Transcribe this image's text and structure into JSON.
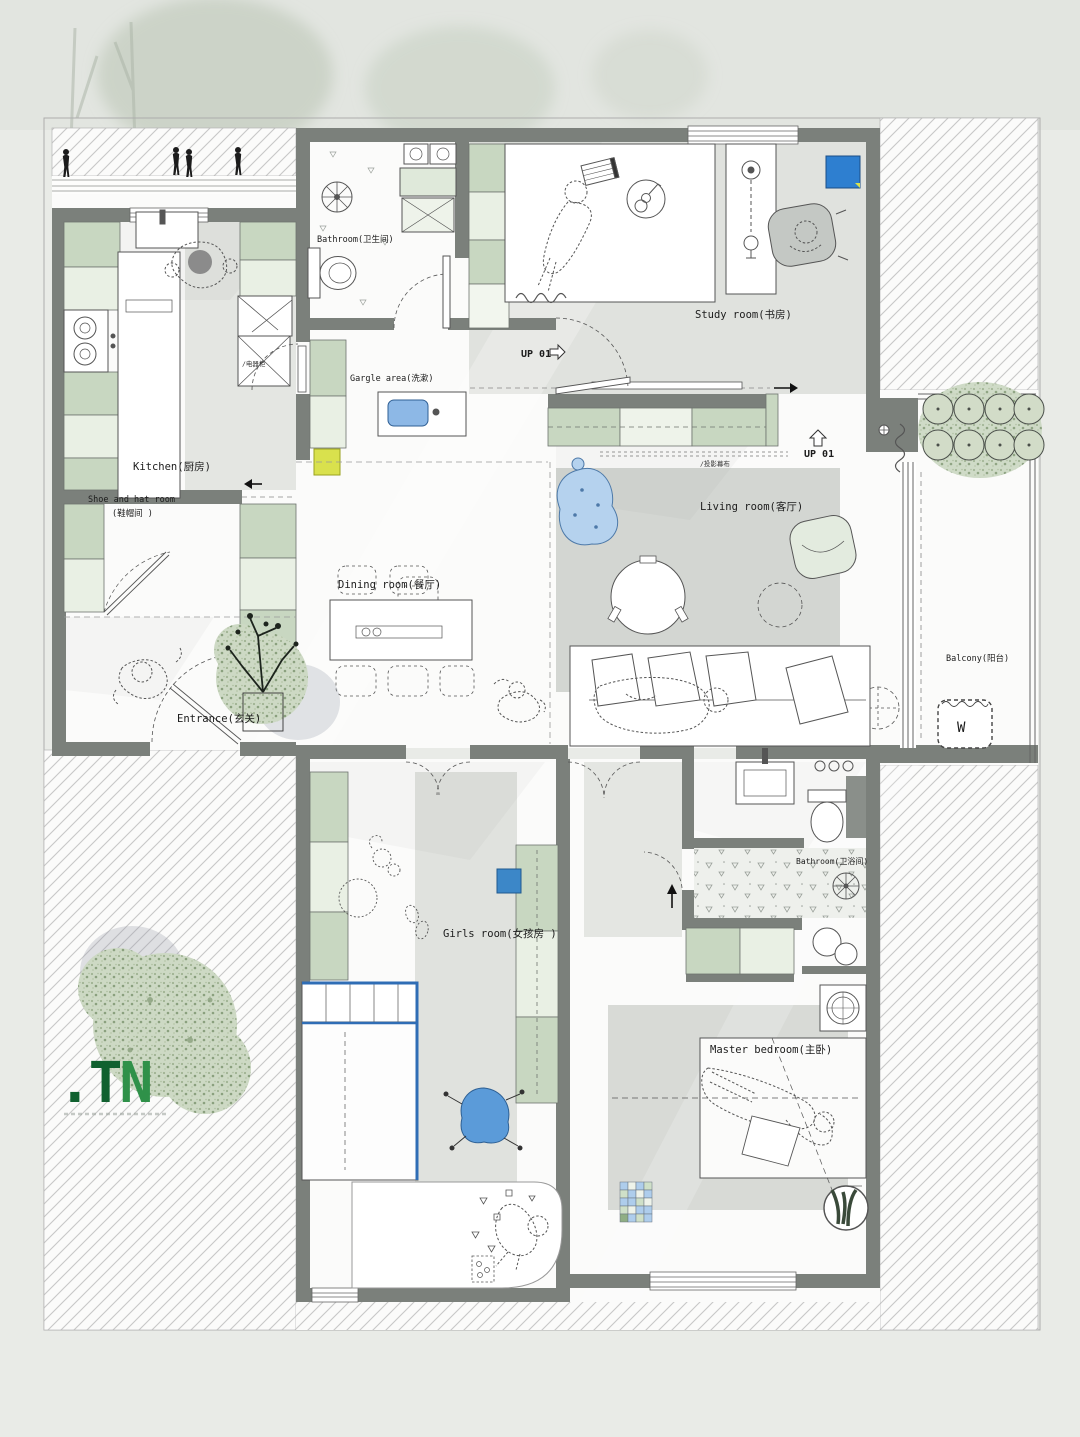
{
  "meta": {
    "type": "architectural floor plan",
    "style": "top-view apartment plan with landscape"
  },
  "colors": {
    "background": "#e9ebe7",
    "wall": "#7b807b",
    "cabinet_green": "#c8d7c1",
    "cabinet_light": "#e9f0e4",
    "floor_white": "#fcfcfb",
    "floor_shade": "#dfe1dd",
    "rug_gray": "#d3d6d2",
    "accent_blue": "#3c87c8",
    "bed_blue": "#2f6db5",
    "beanbag_blue": "#b5d2ee",
    "accent_yellow": "#d9e14d",
    "logo_green_dark": "#10612f",
    "logo_green_light": "#2f9149",
    "hatch_line": "#c7c7c7",
    "moss_green": "#cdd9c4"
  },
  "rooms": {
    "bathroom_top": "Bathroom(卫生间)",
    "gargle": "Gargle area(洗漱)",
    "kitchen": "Kitchen(厨房)",
    "shoe_hat_line1": "Shoe and hat room",
    "shoe_hat_line2": "(鞋帽间 )",
    "study": "Study room(书房)",
    "living": "Living room(客厅)",
    "dining": "Dining room(餐厅)",
    "entrance": "Entrance(玄关)",
    "balcony": "Balcony(阳台)",
    "girls": "Girls room(女孩房 )",
    "bathroom_bottom": "Bathroom(卫浴间)",
    "master": "Master bedroom(主卧)"
  },
  "annotations": {
    "up_stair_a": "UP 01",
    "up_stair_b": "UP 01",
    "washer": "W",
    "projector_screen": "/投影幕布",
    "appliance_cabinet": "/电器柜"
  },
  "logo": {
    "text_dot": ".",
    "text_t": "T",
    "text_n": "N"
  }
}
